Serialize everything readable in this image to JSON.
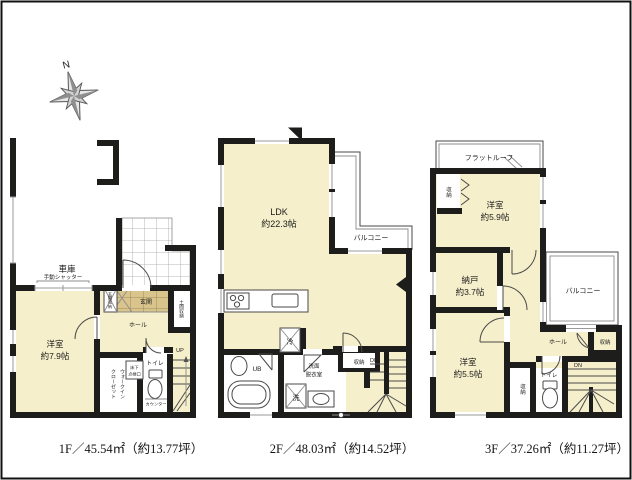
{
  "compass": {
    "north": "N"
  },
  "colors": {
    "wall": "#1d1d1b",
    "room_fill": "#f6efcb",
    "entrance_fill": "#d9c48c",
    "background": "#ffffff"
  },
  "floors": [
    {
      "name": "1F",
      "caption": "1F／45.54㎡（約13.77坪）",
      "labels": {
        "garage": "車庫",
        "shutter": "手動シャッター",
        "room_name": "洋室",
        "room_size": "約7.9帖",
        "entrance": "玄関",
        "entrance_storage": "玄関収納",
        "dirt_floor_storage": "土間収納",
        "hall": "ホール",
        "wic_line1": "ウォークイン",
        "wic_line2": "クローゼット",
        "underfloor_hatch_line1": "床下",
        "underfloor_hatch_line2": "点検口",
        "toilet": "トイレ",
        "counter": "カウンター",
        "up": "UP"
      }
    },
    {
      "name": "2F",
      "caption": "2F／48.03㎡（約14.52坪）",
      "labels": {
        "ldk_name": "LDK",
        "ldk_size": "約22.3帖",
        "balcony": "バルコニー",
        "fridge": "冷",
        "bath": "UB",
        "washroom_line1": "洗面",
        "washroom_line2": "脱衣室",
        "laundry": "洗",
        "storage": "収納",
        "up": "UP",
        "down": "DN"
      }
    },
    {
      "name": "3F",
      "caption": "3F／37.26㎡（約11.27坪）",
      "labels": {
        "flat_roof": "フラットルーフ",
        "storage_top": "収納",
        "room1_name": "洋室",
        "room1_size": "約5.9帖",
        "storeroom_name": "納戸",
        "storeroom_size": "約3.7帖",
        "balcony": "バルコニー",
        "hall": "ホール",
        "storage_right": "収納",
        "room2_name": "洋室",
        "room2_size": "約5.5帖",
        "storage_bottom": "収納",
        "toilet": "トイレ",
        "down": "DN"
      }
    }
  ]
}
